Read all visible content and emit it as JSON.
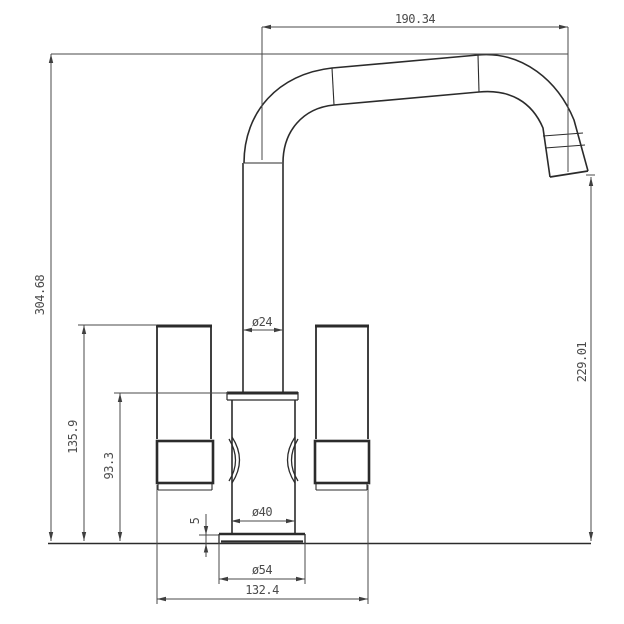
{
  "drawing": {
    "subject": "kitchen mixer tap front elevation",
    "dimensions": {
      "spout_reach": "190.34",
      "overall_height": "304.68",
      "outlet_height": "229.01",
      "handle_top_height": "135.9",
      "body_top_height": "93.3",
      "spout_tube_diameter": "ø24",
      "body_diameter": "ø40",
      "base_diameter": "ø54",
      "handle_span_width": "132.4",
      "base_lip_height": "5"
    },
    "colors": {
      "object_line": "#2b2b2b",
      "dimension_line": "#4a4a4a",
      "dimension_text": "#4b4b4b",
      "background": "#ffffff"
    }
  }
}
